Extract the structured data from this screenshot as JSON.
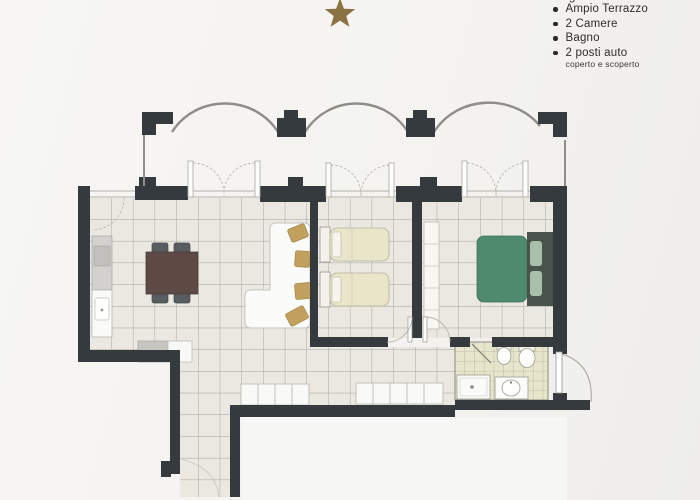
{
  "header": {
    "star_color": "#8a7342",
    "partial_text": "g"
  },
  "features_list": {
    "items": [
      {
        "label": "Ampio Terrazzo"
      },
      {
        "label": "2 Camere"
      },
      {
        "label": "Bagno"
      },
      {
        "label": "2 posti auto",
        "sublabel": "coperto e scoperto"
      }
    ]
  },
  "floorplan": {
    "colors": {
      "wall": "#343a3e",
      "tile_floor": "#eae8e1",
      "tile_line": "#a3a199",
      "bath_tile": "#e7e6cb",
      "bed_cream": "#e9e5c8",
      "bed_green": "#4f8a6c",
      "headboard_dark": "#4b544c",
      "gold_chair": "#c2a15f",
      "dining_table": "#5d4a44",
      "chair_gray": "#585d61",
      "parapet_line": "#8f8d88"
    }
  }
}
